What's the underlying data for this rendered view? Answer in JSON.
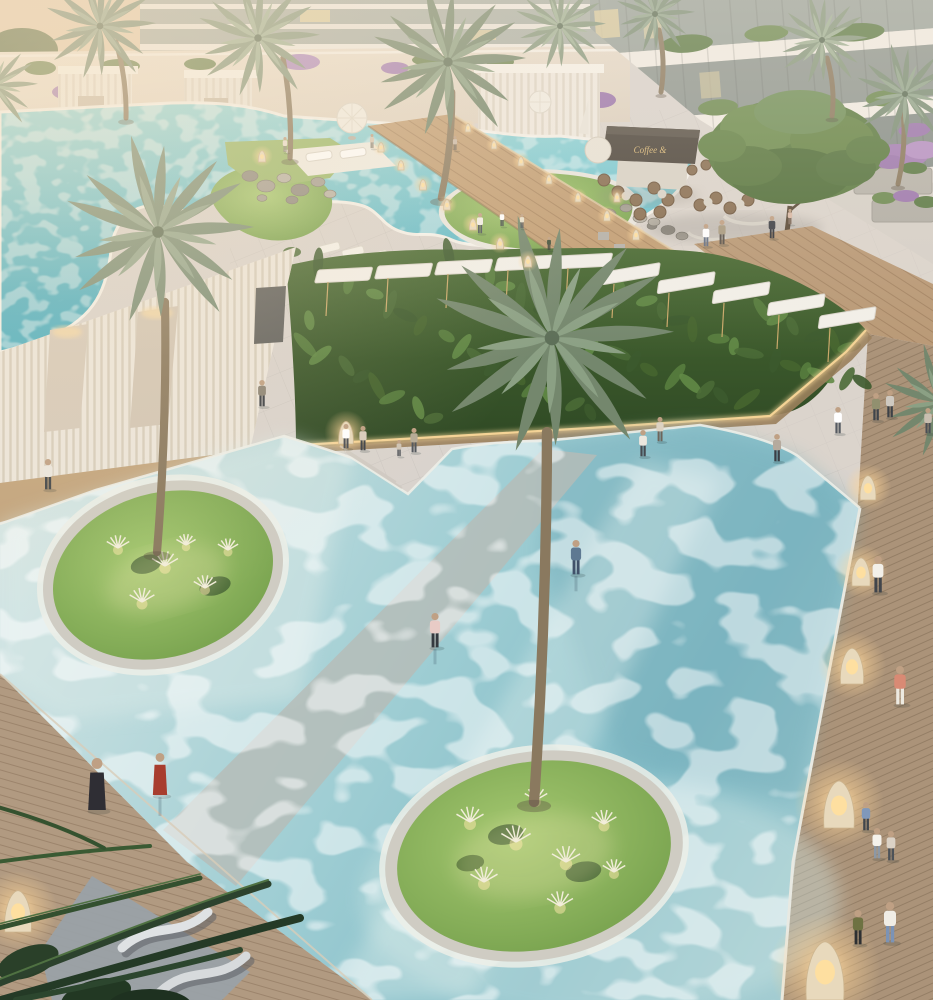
{
  "meta": {
    "title": "Resort courtyard pool — dusk aerial rendering",
    "media_type": "3d-architectural-rendering"
  },
  "scene": {
    "description": "Aerial dusk view of a luxury resort courtyard: a lagoon pool with grass islands and loungers above, a café plaza with a shade tree, a tropical hedge with white shade sails, a large shallow reflecting pool with two circular palm islands, a timber boardwalk with glowing wicker lanterns on the right and a wooden sun deck with curved loungers at lower left.",
    "cafe": {
      "sign": "Coffee &"
    },
    "flag_color": "#e8d24a",
    "palette": {
      "pavement": "#d9d3cd",
      "wall_cream": "#e7dccd",
      "wood_ramp": "#c29e74",
      "boardwalk": "#ab9379",
      "lagoon": "#5cb8c6",
      "main_pool": "#9ecdd3",
      "grass": "#8cb55e",
      "hedge": "#3f5c33",
      "glow": "#ffd99e",
      "sail_white": "#f2efe8"
    },
    "people": [
      {
        "x": 285,
        "y": 152,
        "h": 15,
        "top": "#e8ddcf",
        "bot": "#8b8478"
      },
      {
        "x": 372,
        "y": 148,
        "h": 14,
        "top": "#d6c6b4",
        "bot": "#7d7568"
      },
      {
        "x": 455,
        "y": 150,
        "h": 14,
        "top": "#c9b9a8",
        "bot": "#6f675c"
      },
      {
        "x": 480,
        "y": 233,
        "h": 20,
        "top": "#f2efe8",
        "bot": "#4a5158"
      },
      {
        "x": 502,
        "y": 226,
        "h": 15,
        "top": "#ffffff",
        "bot": "#3c4248"
      },
      {
        "x": 522,
        "y": 228,
        "h": 14,
        "top": "#e8e0cc",
        "bot": "#4d5359"
      },
      {
        "x": 549,
        "y": 250,
        "h": 13,
        "top": "#41503a",
        "bot": "#333a33"
      },
      {
        "x": 706,
        "y": 246,
        "h": 22,
        "top": "#ffffff",
        "bot": "#657084"
      },
      {
        "x": 722,
        "y": 244,
        "h": 24,
        "top": "#a89a80",
        "bot": "#59524a"
      },
      {
        "x": 772,
        "y": 238,
        "h": 22,
        "top": "#3e4148",
        "bot": "#33363c"
      },
      {
        "x": 790,
        "y": 224,
        "h": 15,
        "top": "#d9b9a6",
        "bot": "#8a7668"
      },
      {
        "x": 876,
        "y": 420,
        "h": 27,
        "top": "#91906f",
        "bot": "#3f444b"
      },
      {
        "x": 890,
        "y": 417,
        "h": 27,
        "top": "#cfc9c1",
        "bot": "#3d4147"
      },
      {
        "x": 838,
        "y": 433,
        "h": 26,
        "top": "#ffffff",
        "bot": "#565b62"
      },
      {
        "x": 643,
        "y": 456,
        "h": 26,
        "top": "#ece7de",
        "bot": "#474b51"
      },
      {
        "x": 660,
        "y": 441,
        "h": 24,
        "top": "#dcd2c2",
        "bot": "#6d655b"
      },
      {
        "x": 777,
        "y": 461,
        "h": 27,
        "top": "#b5aa9d",
        "bot": "#3a3e45"
      },
      {
        "x": 928,
        "y": 433,
        "h": 25,
        "top": "#c9beb0",
        "bot": "#4a4f55"
      },
      {
        "x": 346,
        "y": 448,
        "h": 24,
        "top": "#ffffff",
        "bot": "#4a4e54"
      },
      {
        "x": 363,
        "y": 450,
        "h": 24,
        "top": "#d8cdbd",
        "bot": "#3e4349"
      },
      {
        "x": 399,
        "y": 456,
        "h": 16,
        "top": "#cfc4b5",
        "bot": "#474c52"
      },
      {
        "x": 414,
        "y": 452,
        "h": 24,
        "top": "#b5aa96",
        "bot": "#51565c"
      },
      {
        "x": 262,
        "y": 406,
        "h": 26,
        "top": "#8d8577",
        "bot": "#3c4046"
      },
      {
        "x": 48,
        "y": 489,
        "h": 30,
        "top": "#ebe7df",
        "bot": "#404549"
      },
      {
        "x": 576,
        "y": 574,
        "h": 34,
        "top": "#5e7992",
        "bot": "#41526a",
        "refl": true
      },
      {
        "x": 435,
        "y": 647,
        "h": 34,
        "top": "#e8cbc6",
        "bot": "#34393f",
        "refl": true
      },
      {
        "x": 160,
        "y": 795,
        "h": 42,
        "top": "#a83d2e",
        "bot": "#8d3326",
        "style": "dress",
        "refl": true
      },
      {
        "x": 97,
        "y": 810,
        "h": 52,
        "top": "#2f2e34",
        "bot": "#2f2e34",
        "style": "dress"
      },
      {
        "x": 878,
        "y": 592,
        "h": 36,
        "top": "#f3f0e9",
        "bot": "#41454b"
      },
      {
        "x": 900,
        "y": 704,
        "h": 38,
        "top": "#d98a74",
        "bot": "#edeae1"
      },
      {
        "x": 877,
        "y": 858,
        "h": 30,
        "top": "#f5f2eb",
        "bot": "#8c98a5"
      },
      {
        "x": 866,
        "y": 830,
        "h": 28,
        "top": "#8098ba",
        "bot": "#41464c"
      },
      {
        "x": 891,
        "y": 860,
        "h": 29,
        "top": "#dbd2c6",
        "bot": "#4d5258"
      },
      {
        "x": 858,
        "y": 944,
        "h": 34,
        "top": "#6e7242",
        "bot": "#2e3032"
      },
      {
        "x": 890,
        "y": 942,
        "h": 40,
        "top": "#f0ede6",
        "bot": "#7b93b6"
      }
    ],
    "lamps": [
      {
        "x": 868,
        "y": 500,
        "h": 26
      },
      {
        "x": 861,
        "y": 586,
        "h": 30
      },
      {
        "x": 852,
        "y": 684,
        "h": 38
      },
      {
        "x": 839,
        "y": 828,
        "h": 50
      },
      {
        "x": 825,
        "y": 1000,
        "h": 62
      },
      {
        "x": 18,
        "y": 932,
        "h": 44
      },
      {
        "x": 346,
        "y": 444,
        "h": 24
      },
      {
        "x": 262,
        "y": 162,
        "h": 12
      },
      {
        "x": 617,
        "y": 202,
        "h": 10
      }
    ],
    "bollards": [
      {
        "x": 381,
        "y": 152,
        "h": 10
      },
      {
        "x": 401,
        "y": 170,
        "h": 10
      },
      {
        "x": 423,
        "y": 190,
        "h": 11
      },
      {
        "x": 447,
        "y": 210,
        "h": 11
      },
      {
        "x": 473,
        "y": 230,
        "h": 12
      },
      {
        "x": 500,
        "y": 249,
        "h": 12
      },
      {
        "x": 528,
        "y": 267,
        "h": 12
      },
      {
        "x": 468,
        "y": 132,
        "h": 9
      },
      {
        "x": 494,
        "y": 149,
        "h": 9
      },
      {
        "x": 521,
        "y": 166,
        "h": 10
      },
      {
        "x": 549,
        "y": 184,
        "h": 10
      },
      {
        "x": 578,
        "y": 202,
        "h": 10
      },
      {
        "x": 607,
        "y": 221,
        "h": 11
      },
      {
        "x": 636,
        "y": 240,
        "h": 11
      }
    ],
    "palms": [
      {
        "cx": 158,
        "cy": 232,
        "r": 96,
        "t": [
          165,
          302,
          157,
          552
        ],
        "tone": 0
      },
      {
        "cx": 552,
        "cy": 338,
        "r": 122,
        "t": [
          547,
          432,
          534,
          802
        ],
        "tone": 1
      },
      {
        "cx": 100,
        "cy": 26,
        "r": 56,
        "t": [
          116,
          42,
          126,
          118
        ],
        "tone": 0
      },
      {
        "cx": 258,
        "cy": 38,
        "r": 62,
        "t": [
          283,
          58,
          290,
          158
        ],
        "tone": 2
      },
      {
        "cx": 448,
        "cy": 62,
        "r": 78,
        "t": [
          452,
          92,
          441,
          198
        ],
        "tone": 1
      },
      {
        "cx": 560,
        "cy": 26,
        "r": 46,
        "t": null,
        "tone": 2
      },
      {
        "cx": 655,
        "cy": 14,
        "r": 40,
        "t": [
          659,
          30,
          661,
          92
        ],
        "tone": 0
      },
      {
        "cx": 822,
        "cy": 40,
        "r": 46,
        "t": [
          827,
          58,
          832,
          116
        ],
        "tone": 2
      },
      {
        "cx": 905,
        "cy": 94,
        "r": 50,
        "t": [
          903,
          110,
          898,
          184
        ],
        "tone": 0
      },
      {
        "cx": 940,
        "cy": 402,
        "r": 58,
        "t": null,
        "tone": 1
      },
      {
        "cx": -6,
        "cy": 86,
        "r": 44,
        "t": null,
        "tone": 2
      }
    ],
    "tufts": [
      {
        "x": 118,
        "y": 548,
        "s": 1
      },
      {
        "x": 165,
        "y": 566,
        "s": 1.15
      },
      {
        "x": 205,
        "y": 588,
        "s": 1
      },
      {
        "x": 142,
        "y": 602,
        "s": 1.1
      },
      {
        "x": 228,
        "y": 550,
        "s": 0.9
      },
      {
        "x": 186,
        "y": 545,
        "s": 0.85
      },
      {
        "x": 470,
        "y": 822,
        "s": 1.2
      },
      {
        "x": 516,
        "y": 842,
        "s": 1.3
      },
      {
        "x": 566,
        "y": 862,
        "s": 1.25
      },
      {
        "x": 604,
        "y": 824,
        "s": 1.1
      },
      {
        "x": 484,
        "y": 882,
        "s": 1.2
      },
      {
        "x": 560,
        "y": 906,
        "s": 1.15
      },
      {
        "x": 614,
        "y": 872,
        "s": 1
      },
      {
        "x": 536,
        "y": 800,
        "s": 1
      }
    ],
    "rocks": [
      {
        "x": 250,
        "y": 176,
        "r": 8
      },
      {
        "x": 266,
        "y": 186,
        "r": 9
      },
      {
        "x": 284,
        "y": 178,
        "r": 7
      },
      {
        "x": 300,
        "y": 190,
        "r": 9
      },
      {
        "x": 318,
        "y": 182,
        "r": 7
      },
      {
        "x": 330,
        "y": 194,
        "r": 6
      },
      {
        "x": 292,
        "y": 200,
        "r": 6
      },
      {
        "x": 262,
        "y": 198,
        "r": 5
      },
      {
        "x": 592,
        "y": 206,
        "r": 7
      },
      {
        "x": 608,
        "y": 214,
        "r": 8
      },
      {
        "x": 626,
        "y": 208,
        "r": 6
      },
      {
        "x": 640,
        "y": 218,
        "r": 7
      },
      {
        "x": 652,
        "y": 226,
        "r": 5
      },
      {
        "x": 618,
        "y": 224,
        "r": 5
      },
      {
        "x": 654,
        "y": 222,
        "r": 6
      },
      {
        "x": 668,
        "y": 230,
        "r": 7
      },
      {
        "x": 682,
        "y": 236,
        "r": 6
      }
    ],
    "sails": [
      {
        "x": 318,
        "y": 270
      },
      {
        "x": 378,
        "y": 266
      },
      {
        "x": 438,
        "y": 262
      },
      {
        "x": 498,
        "y": 258
      },
      {
        "x": 558,
        "y": 256
      },
      {
        "x": 604,
        "y": 272
      },
      {
        "x": 659,
        "y": 281
      },
      {
        "x": 714,
        "y": 291
      },
      {
        "x": 769,
        "y": 303
      },
      {
        "x": 820,
        "y": 316
      }
    ],
    "counts": {
      "people": 34,
      "wicker_lanterns": 9,
      "path_bollards": 14,
      "palm_trees": 11
    }
  }
}
